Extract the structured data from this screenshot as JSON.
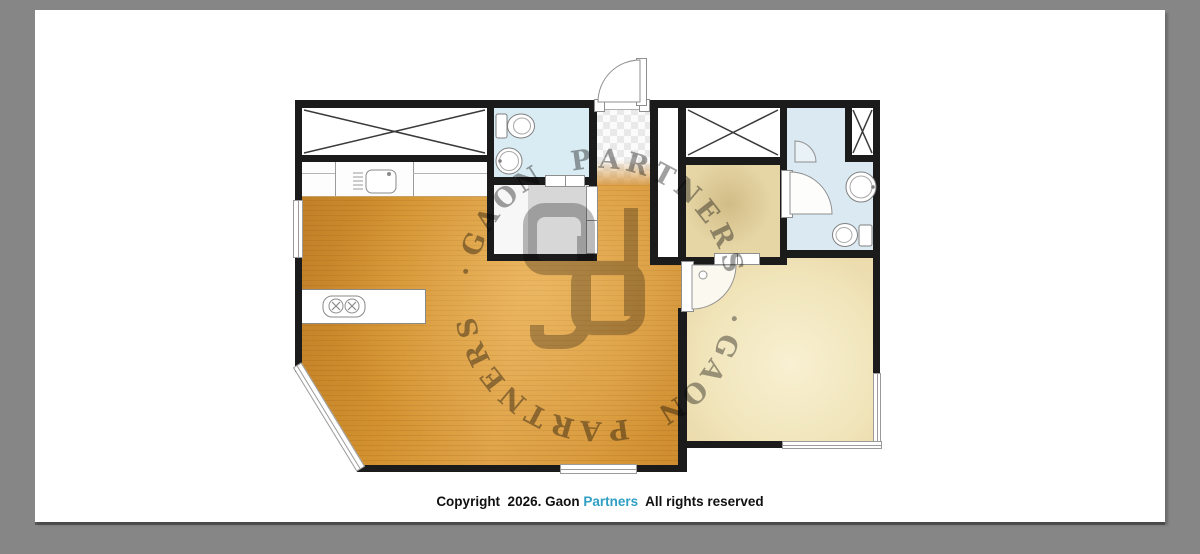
{
  "footer": {
    "copyright_parts": [
      {
        "text": "Copyright  2026. Gaon ",
        "color": "#111111"
      },
      {
        "text": "Partners",
        "color": "#2f9fc4"
      },
      {
        "text": "  All rights reserved",
        "color": "#111111"
      }
    ]
  },
  "watermark": {
    "ring_text": "GAON PARTNERS ·GAON PARTNERS ·",
    "monogram_letters": "gp",
    "color": "#7e7e7e"
  },
  "plan": {
    "rooms": [
      {
        "name": "living-room-kitchen",
        "floor_color": "#d3922f"
      },
      {
        "name": "storage-closet-crossed",
        "floor_color": "#ffffff"
      },
      {
        "name": "bathroom-left",
        "floor_color": "#d9ecf3"
      },
      {
        "name": "utility-room",
        "floor_color": "#d7d7d7"
      },
      {
        "name": "entry-tile",
        "floor_color": "#e9e9e9"
      },
      {
        "name": "closet-right-crossed",
        "floor_color": "#ffffff"
      },
      {
        "name": "dressing-room",
        "floor_color": "#e6d6a6"
      },
      {
        "name": "bathroom-right",
        "floor_color": "#dbeaf2"
      },
      {
        "name": "bedroom",
        "floor_color": "#f0e4b9"
      }
    ],
    "wall_color": "#1b1b1b",
    "page_background": "#868686",
    "canvas_color": "#ffffff"
  }
}
